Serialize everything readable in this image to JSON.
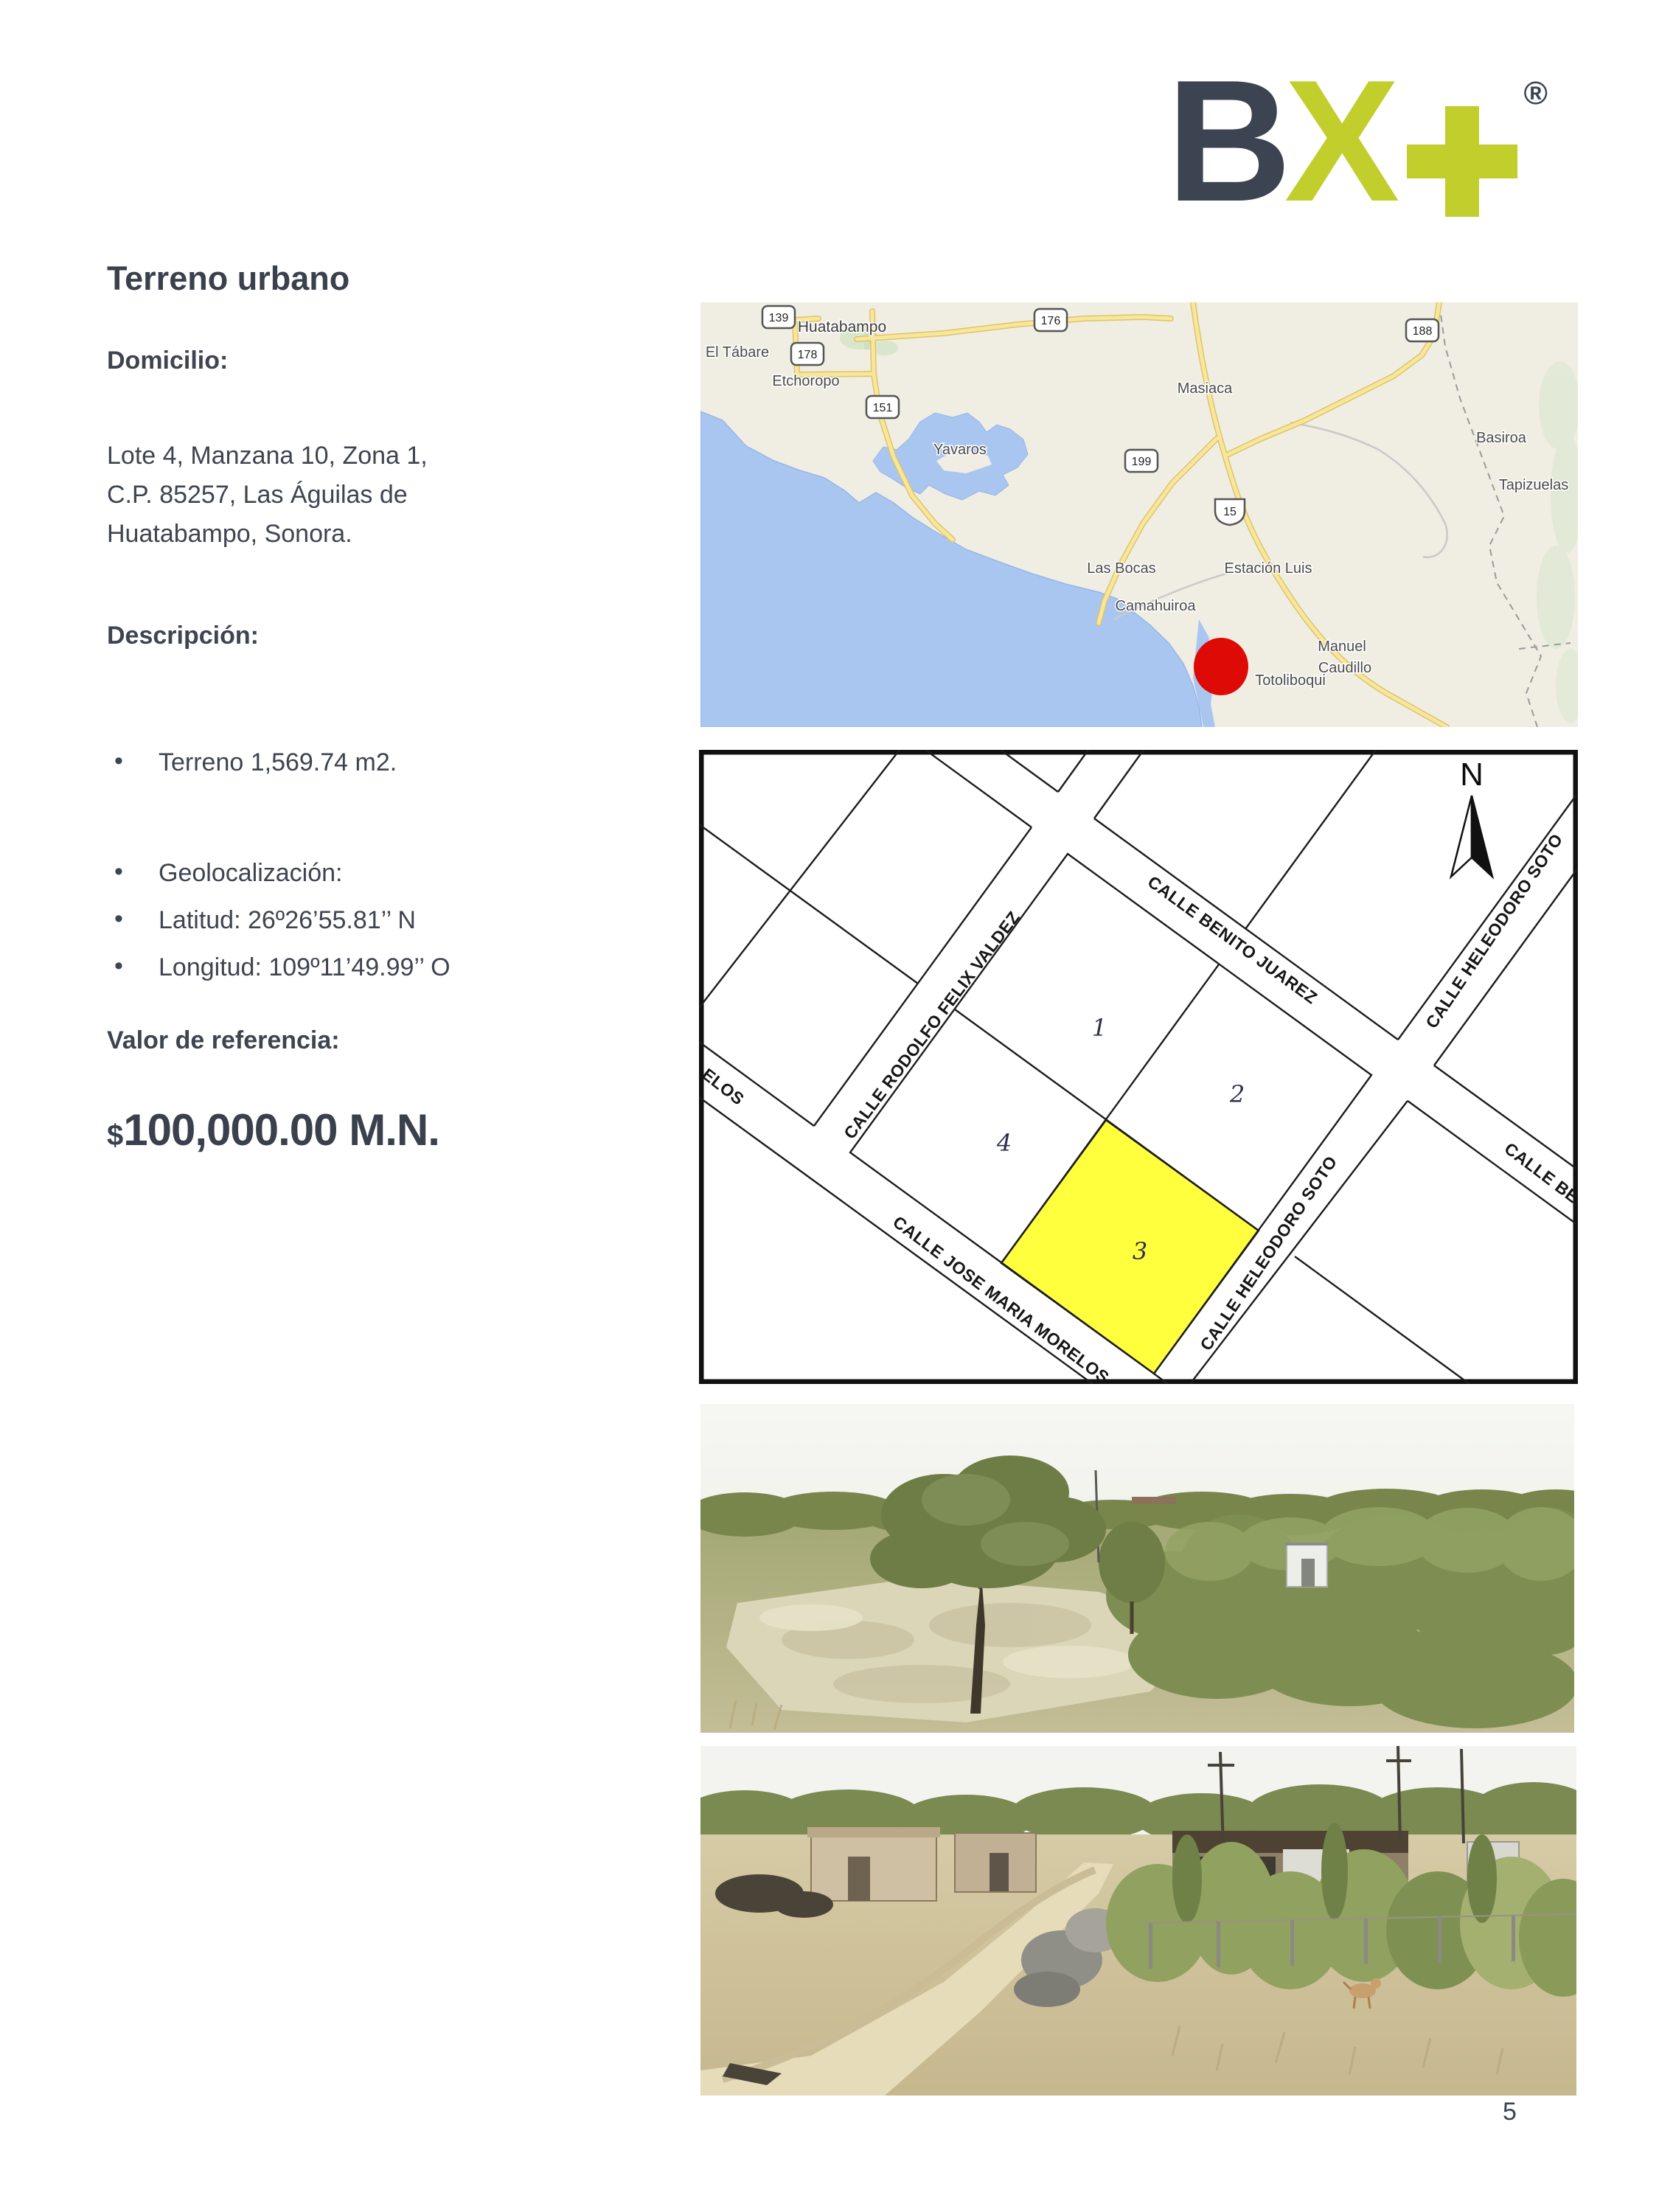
{
  "document": {
    "page_number": "5"
  },
  "logo": {
    "letter_b": "B",
    "letter_x": "X",
    "registered_mark": "®",
    "accent_color": "#c1ce2b",
    "dark_color": "#3b4450"
  },
  "listing": {
    "title": "Terreno urbano",
    "address_heading": "Domicilio:",
    "address_lines": [
      "Lote 4, Manzana 10, Zona 1,",
      "C.P. 85257,  Las Águilas de",
      "Huatabampo, Sonora."
    ],
    "description_heading": "Descripción:",
    "features": [
      "Terreno 1,569.74 m2."
    ],
    "geo_features": [
      "Geolocalización:",
      "Latitud: 26º26’55.81’’ N",
      "Longitud: 109º11’49.99’’ O"
    ],
    "value_heading": "Valor de referencia:",
    "currency_symbol": "$",
    "reference_value": "100,000.00 M.N."
  },
  "locator_map": {
    "towns": [
      "Huatabampo",
      "El Tábare",
      "Etchoropo",
      "Yavaros",
      "Masiaca",
      "Basiroa",
      "Tapizuelas",
      "Las Bocas",
      "Estación Luis",
      "Camahuiroa",
      "Manuel",
      "Caudillo",
      "Totoliboqui"
    ],
    "route_shields": [
      "139",
      "176",
      "188",
      "178",
      "151",
      "199",
      "15"
    ],
    "marker_color": "#dd0a06",
    "land_color": "#f0ede3",
    "water_color": "#a9c6f1",
    "road_color": "#f7e79c"
  },
  "site_plan": {
    "north_label": "N",
    "street_labels": [
      "CALLE RODOLFO FELIX VALDEZ",
      "CALLE BENITO JUAREZ",
      "CALLE HELEODORO SOTO",
      "CALLE HELEODORO SOTO",
      "CALLE JOSE MARIA MORELOS",
      "ELOS",
      "CALLE BEN"
    ],
    "lot_numbers": [
      "1",
      "2",
      "3",
      "4"
    ],
    "highlight_color": "#ffff3d"
  }
}
